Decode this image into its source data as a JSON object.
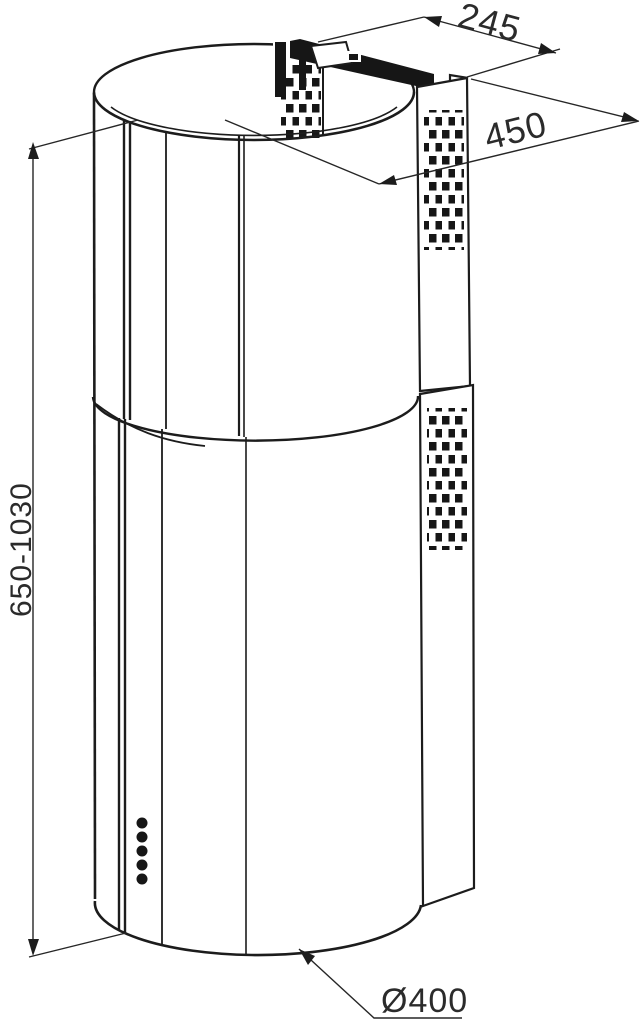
{
  "drawing": {
    "type": "dimensioned technical line drawing",
    "subject": "cylindrical island cooker hood with telescopic chimney",
    "colors": {
      "line": "#1c1c1c",
      "background": "#ffffff"
    },
    "dimensions": {
      "top_bracket_width": {
        "label": "245"
      },
      "top_depth": {
        "label": "450"
      },
      "height_range": {
        "label": "650-1030"
      },
      "body_diameter": {
        "label": "Ø400"
      }
    }
  }
}
